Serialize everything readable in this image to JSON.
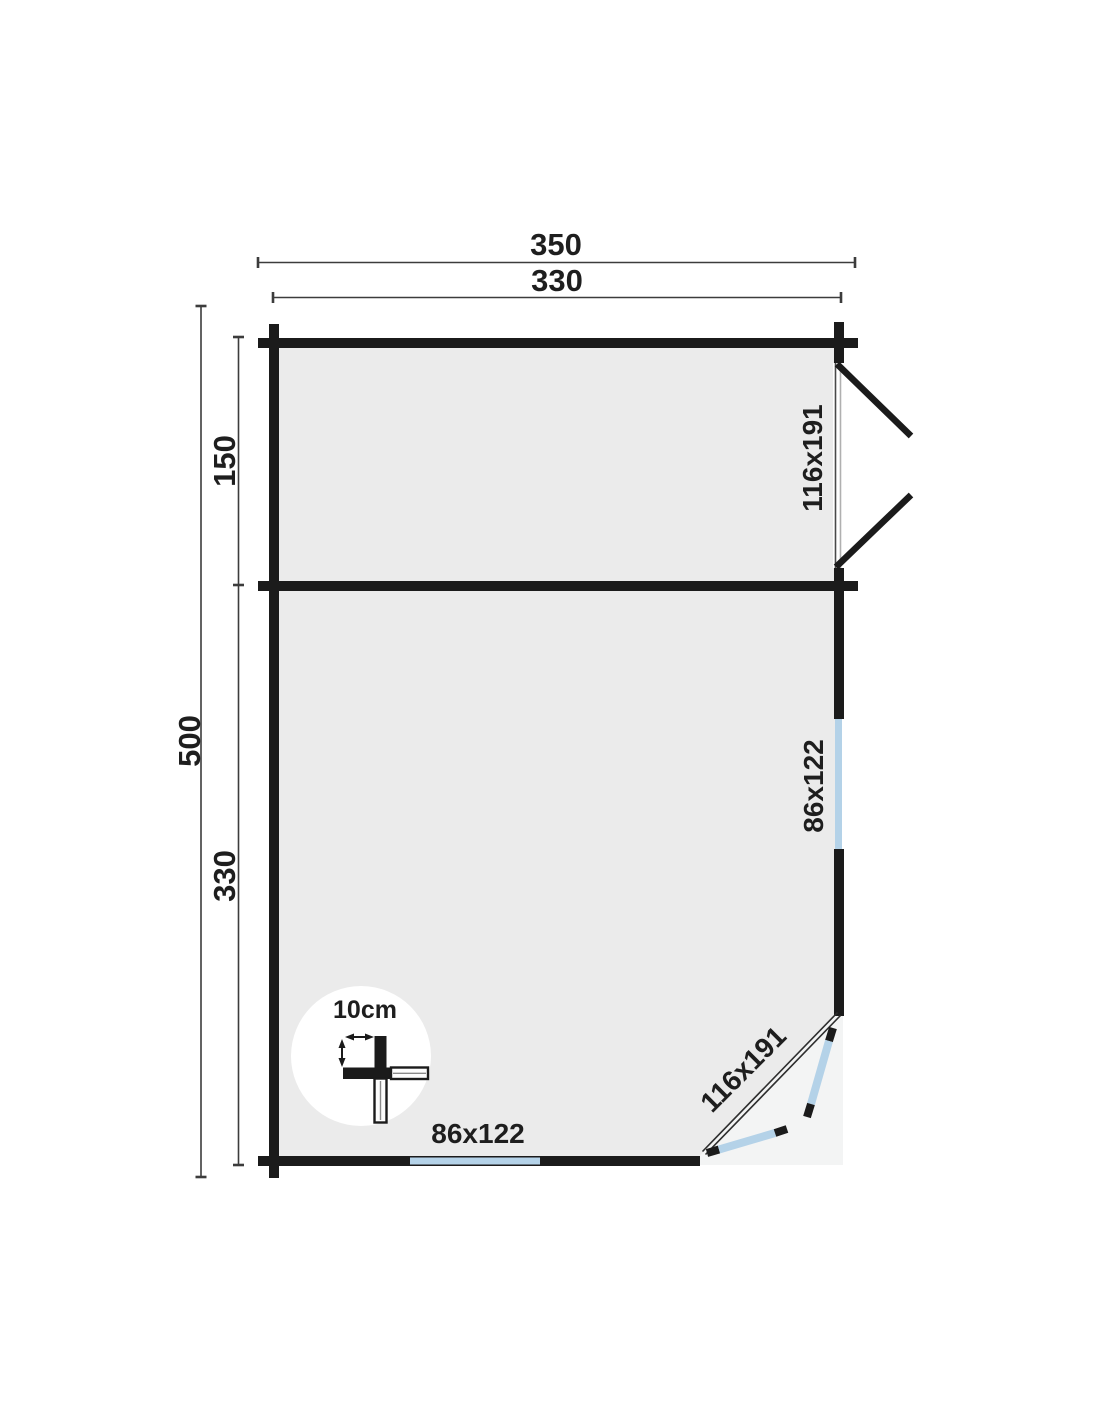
{
  "plan": {
    "dimensions": {
      "overall_width": "350",
      "inner_width": "330",
      "overall_depth": "500",
      "porch_depth": "150",
      "main_room_depth": "330"
    },
    "openings": {
      "porch_double_door": "116x191",
      "side_window": "86x122",
      "front_window": "86x122",
      "corner_double_door": "116x191"
    },
    "scale_indicator": {
      "wall_thickness": "10cm"
    },
    "colors": {
      "wall": "#1b1b1b",
      "dimension": "#3c3c3c",
      "window": "#b4d2e8",
      "floor": "#ebebeb",
      "corner_floor": "#f3f4f4",
      "text": "#1e1e1e",
      "frame_dark": "#4a4a4a",
      "frame_light": "#b0b0b0",
      "door_line": "#2e2e2e"
    }
  }
}
